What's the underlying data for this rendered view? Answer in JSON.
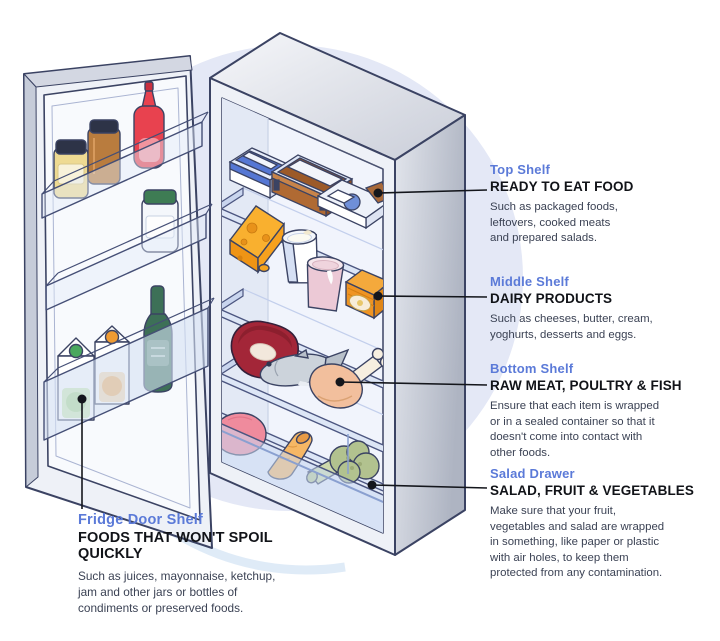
{
  "title": "Fridge food storage zones diagram",
  "colors": {
    "label_blue": "#5b7ad8",
    "heading_black": "#111318",
    "body_text": "#3b4254",
    "background_circle": "#e4e8f6",
    "background_ring": "#dce9f7",
    "illustration_outline": "#3b4363",
    "callout_line": "#14161c"
  },
  "callouts": [
    {
      "id": "top-shelf",
      "label": "Top Shelf",
      "heading": "READY TO EAT FOOD",
      "body": [
        "Such as packaged foods,",
        "leftovers, cooked meats",
        "and prepared salads."
      ]
    },
    {
      "id": "middle-shelf",
      "label": "Middle Shelf",
      "heading": "DAIRY PRODUCTS",
      "body": [
        "Such as cheeses, butter, cream,",
        "yoghurts, desserts and eggs."
      ]
    },
    {
      "id": "bottom-shelf",
      "label": "Bottom Shelf",
      "heading": "RAW MEAT, POULTRY & FISH",
      "body": [
        "Ensure that each item is wrapped",
        "or in a sealed container so that it",
        "doesn't come into contact with",
        "other foods."
      ]
    },
    {
      "id": "salad-drawer",
      "label": "Salad Drawer",
      "heading": "SALAD, FRUIT & VEGETABLES",
      "body": [
        "Make sure that your fruit,",
        "vegetables and salad are wrapped",
        "in something, like paper or plastic",
        "with air holes, to keep them",
        "protected from any contamination."
      ]
    },
    {
      "id": "fridge-door-shelf",
      "label": "Fridge Door Shelf",
      "heading": "FOODS THAT WON'T SPOIL QUICKLY",
      "body": [
        "Such as juices, mayonnaise, ketchup,",
        "jam and other jars or bottles of",
        "condiments or preserved foods."
      ]
    }
  ],
  "illustration_items": {
    "top_shelf": [
      "storage-container-blue",
      "storage-container-leftovers",
      "ready-meal-package"
    ],
    "middle_shelf": [
      "cheese-wedge",
      "milk-cup",
      "yoghurt-cup",
      "butter-pack"
    ],
    "bottom_shelf": [
      "raw-steak",
      "fish",
      "chicken-leg"
    ],
    "salad_drawer": [
      "tomato",
      "carrot",
      "broccoli"
    ],
    "door_bins": [
      "mayonnaise-jar",
      "jam-jar",
      "ketchup-bottle",
      "pickle-jar",
      "apple-juice-carton",
      "orange-juice-carton",
      "green-bottle"
    ]
  }
}
